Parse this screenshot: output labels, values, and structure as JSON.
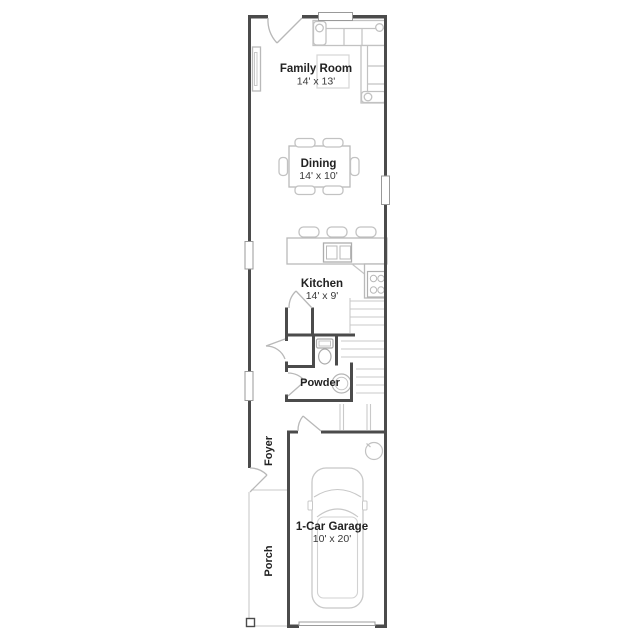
{
  "rooms": {
    "family_room": {
      "name": "Family Room",
      "dims": "14' x 13'"
    },
    "dining": {
      "name": "Dining",
      "dims": "14' x 10'"
    },
    "kitchen": {
      "name": "Kitchen",
      "dims": "14' x 9'"
    },
    "powder": {
      "name": "Powder"
    },
    "foyer": {
      "name": "Foyer"
    },
    "porch": {
      "name": "Porch"
    },
    "garage": {
      "name": "1-Car Garage",
      "dims": "10' x 20'"
    }
  },
  "fixtures": [
    "sectional-sofa",
    "media-console",
    "rug",
    "window",
    "dining-table",
    "dining-chairs",
    "kitchen-island",
    "island-sink",
    "bar-stools",
    "range",
    "counter",
    "pantry-door",
    "closet-door",
    "toilet",
    "powder-sink",
    "staircase",
    "water-heater",
    "car",
    "garage-door",
    "front-door",
    "porch-post"
  ],
  "colors": {
    "wall": "#4b4b4b",
    "fixture": "#bdbdbd",
    "light_fixture": "#c9c9c9",
    "text": "#222222",
    "background": "#ffffff"
  }
}
